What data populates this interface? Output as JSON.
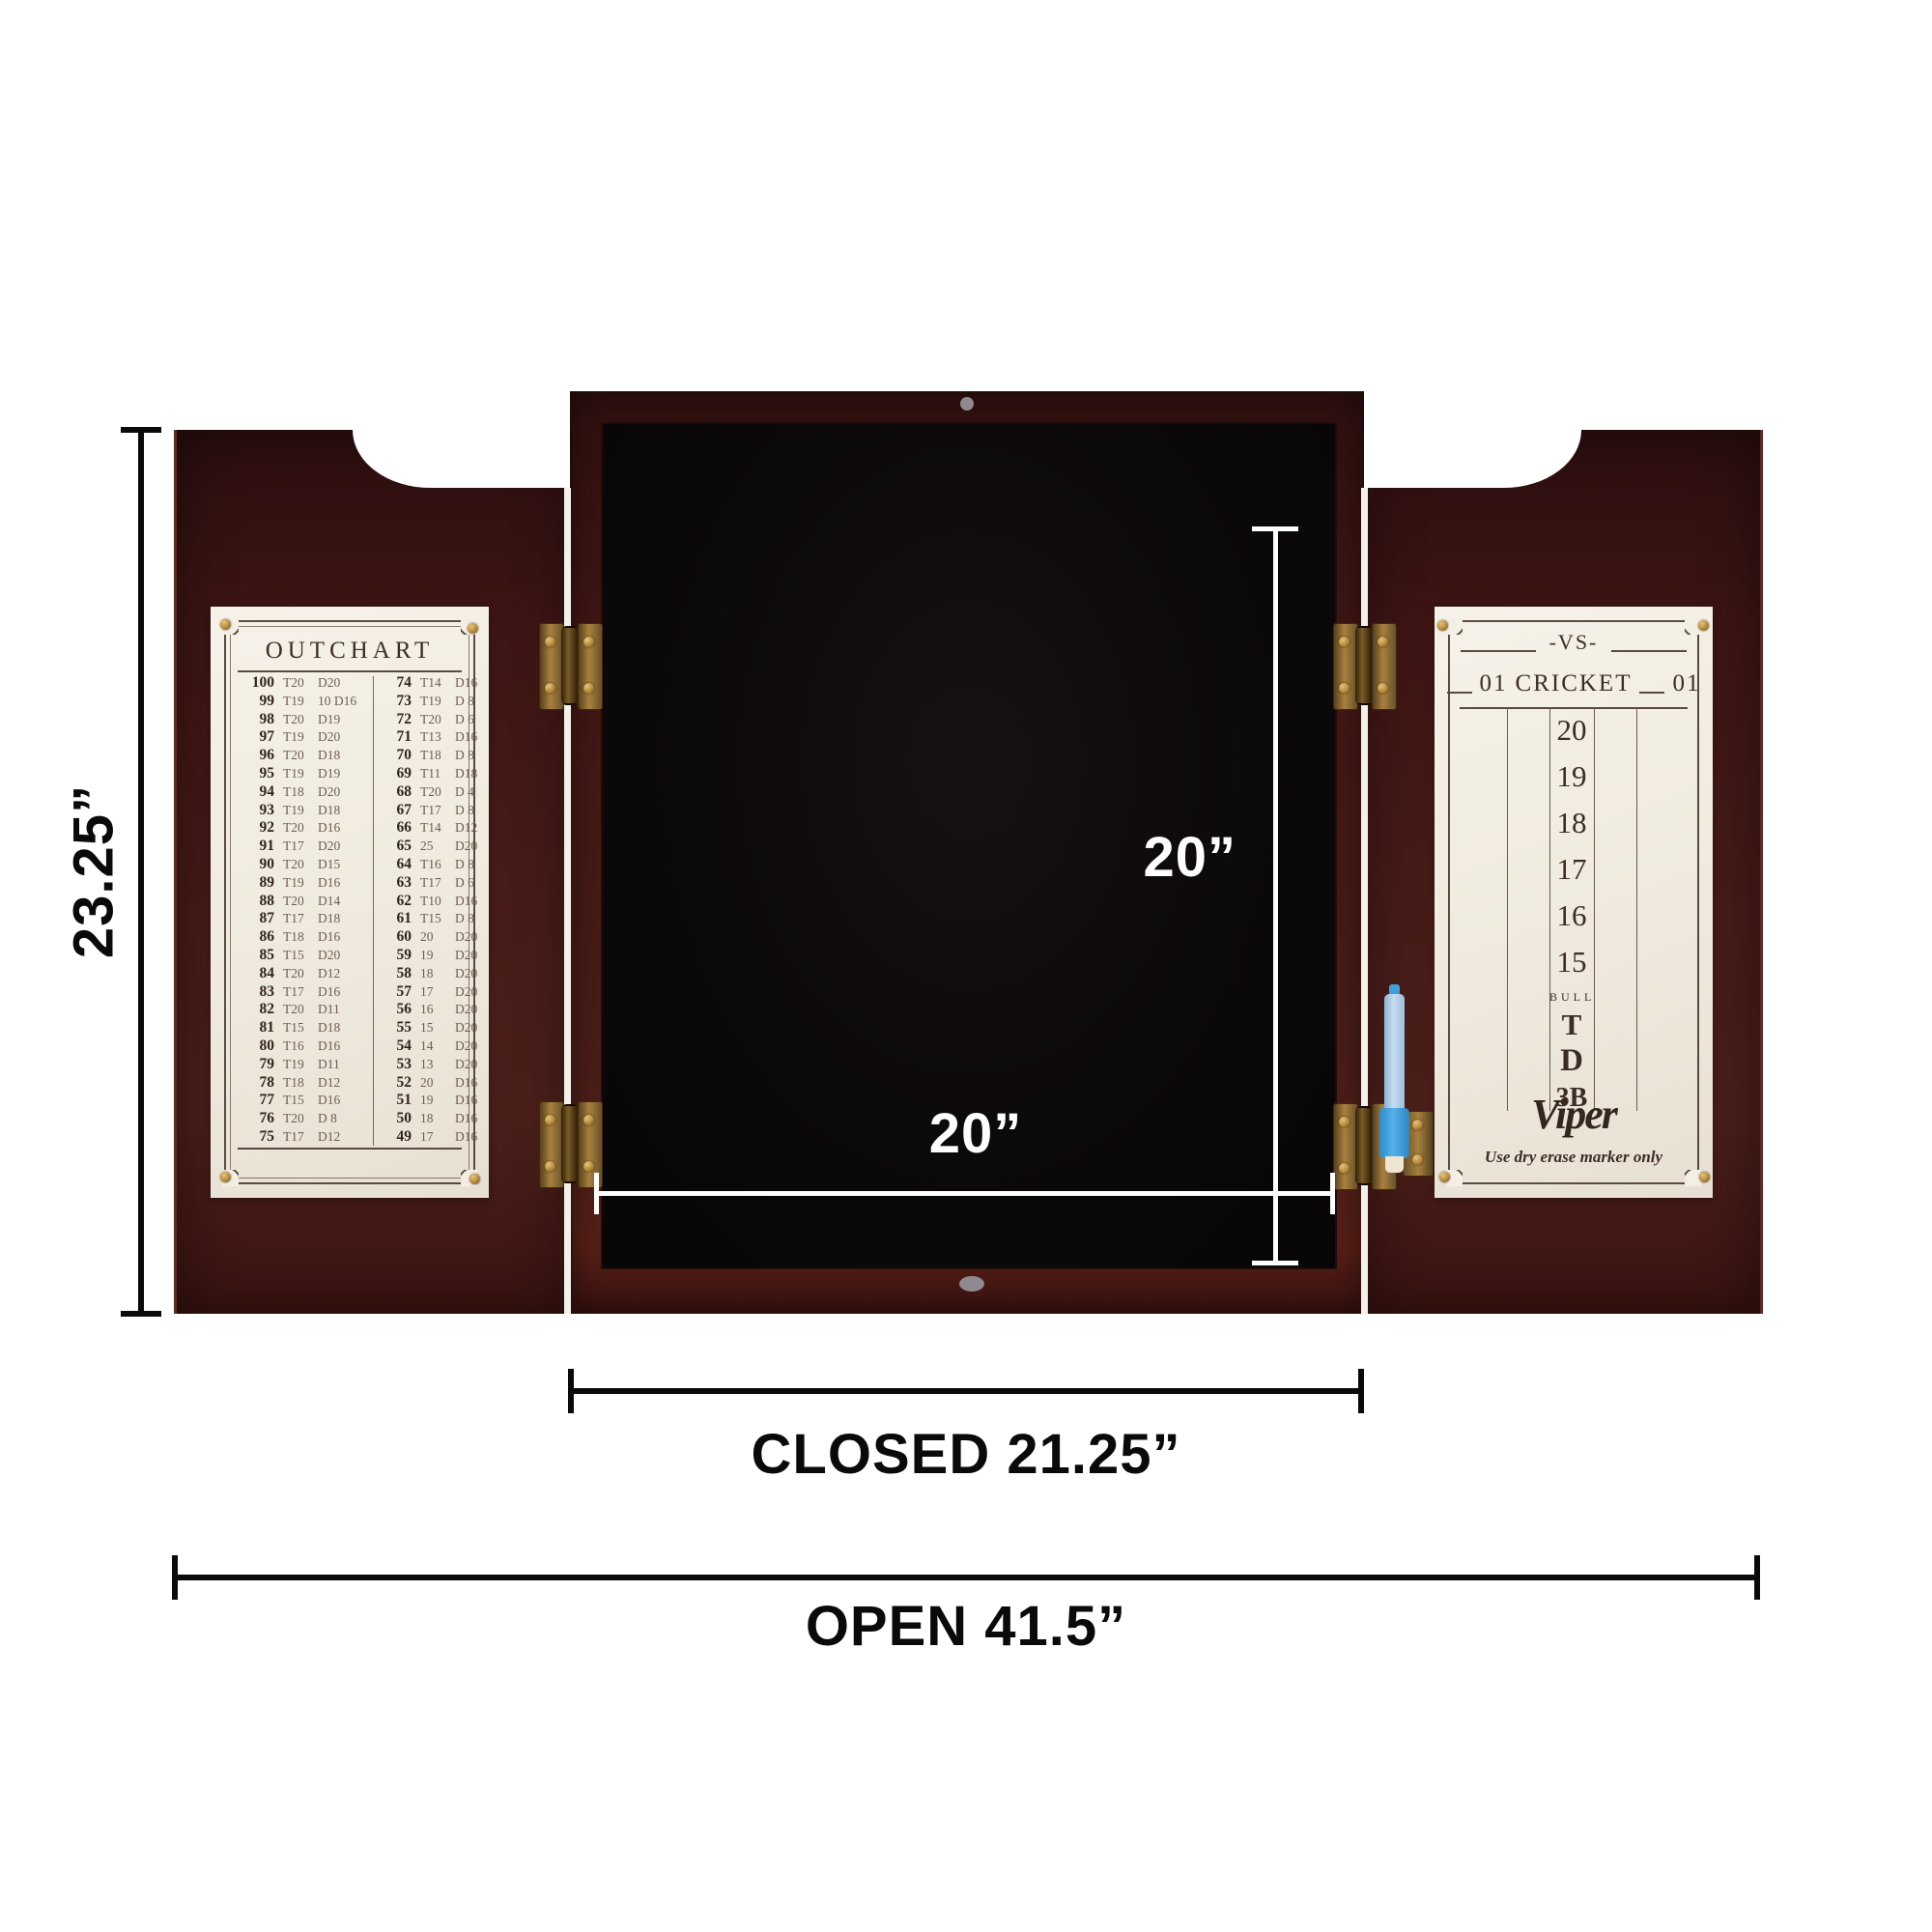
{
  "product": {
    "description": "Open dartboard cabinet, mahogany finish, with outchart door, cricket scoreboard door and dry-erase marker"
  },
  "dimensions": {
    "height_label": "23.25”",
    "inner_height_label": "20”",
    "inner_width_label": "20”",
    "closed_label": "CLOSED 21.25”",
    "open_label": "OPEN 41.5”"
  },
  "outchart": {
    "title": "OUTCHART",
    "left_rows": [
      [
        "100",
        "T20",
        "D20"
      ],
      [
        "99",
        "T19",
        "10 D16"
      ],
      [
        "98",
        "T20",
        "D19"
      ],
      [
        "97",
        "T19",
        "D20"
      ],
      [
        "96",
        "T20",
        "D18"
      ],
      [
        "95",
        "T19",
        "D19"
      ],
      [
        "94",
        "T18",
        "D20"
      ],
      [
        "93",
        "T19",
        "D18"
      ],
      [
        "92",
        "T20",
        "D16"
      ],
      [
        "91",
        "T17",
        "D20"
      ],
      [
        "90",
        "T20",
        "D15"
      ],
      [
        "89",
        "T19",
        "D16"
      ],
      [
        "88",
        "T20",
        "D14"
      ],
      [
        "87",
        "T17",
        "D18"
      ],
      [
        "86",
        "T18",
        "D16"
      ],
      [
        "85",
        "T15",
        "D20"
      ],
      [
        "84",
        "T20",
        "D12"
      ],
      [
        "83",
        "T17",
        "D16"
      ],
      [
        "82",
        "T20",
        "D11"
      ],
      [
        "81",
        "T15",
        "D18"
      ],
      [
        "80",
        "T16",
        "D16"
      ],
      [
        "79",
        "T19",
        "D11"
      ],
      [
        "78",
        "T18",
        "D12"
      ],
      [
        "77",
        "T15",
        "D16"
      ],
      [
        "76",
        "T20",
        "D 8"
      ],
      [
        "75",
        "T17",
        "D12"
      ]
    ],
    "right_rows": [
      [
        "74",
        "T14",
        "D16"
      ],
      [
        "73",
        "T19",
        "D 8"
      ],
      [
        "72",
        "T20",
        "D 6"
      ],
      [
        "71",
        "T13",
        "D16"
      ],
      [
        "70",
        "T18",
        "D 8"
      ],
      [
        "69",
        "T11",
        "D18"
      ],
      [
        "68",
        "T20",
        "D 4"
      ],
      [
        "67",
        "T17",
        "D 8"
      ],
      [
        "66",
        "T14",
        "D12"
      ],
      [
        "65",
        "25",
        "D20"
      ],
      [
        "64",
        "T16",
        "D 8"
      ],
      [
        "63",
        "T17",
        "D 6"
      ],
      [
        "62",
        "T10",
        "D16"
      ],
      [
        "61",
        "T15",
        "D 8"
      ],
      [
        "60",
        "20",
        "D20"
      ],
      [
        "59",
        "19",
        "D20"
      ],
      [
        "58",
        "18",
        "D20"
      ],
      [
        "57",
        "17",
        "D20"
      ],
      [
        "56",
        "16",
        "D20"
      ],
      [
        "55",
        "15",
        "D20"
      ],
      [
        "54",
        "14",
        "D20"
      ],
      [
        "53",
        "13",
        "D20"
      ],
      [
        "52",
        "20",
        "D16"
      ],
      [
        "51",
        "19",
        "D16"
      ],
      [
        "50",
        "18",
        "D16"
      ],
      [
        "49",
        "17",
        "D16"
      ]
    ]
  },
  "scoreboard": {
    "vs_label": "-VS-",
    "header_left": "01",
    "header_center": "CRICKET",
    "header_right": "01",
    "numbers": [
      "20",
      "19",
      "18",
      "17",
      "16",
      "15"
    ],
    "bull_label": "BULL",
    "triple_label": "T",
    "double_label": "D",
    "three_b_label": "3B",
    "brand": "Viper",
    "footnote": "Use dry erase marker only"
  },
  "colors": {
    "wood": "#451c18",
    "interior_black": "#0c090a",
    "paper": "#f3eee4",
    "ink": "#43332a",
    "brass": "#a8813f",
    "marker_blue": "#3f9fe0",
    "dimension_black": "#0a0a0a",
    "dimension_white": "#ffffff"
  }
}
